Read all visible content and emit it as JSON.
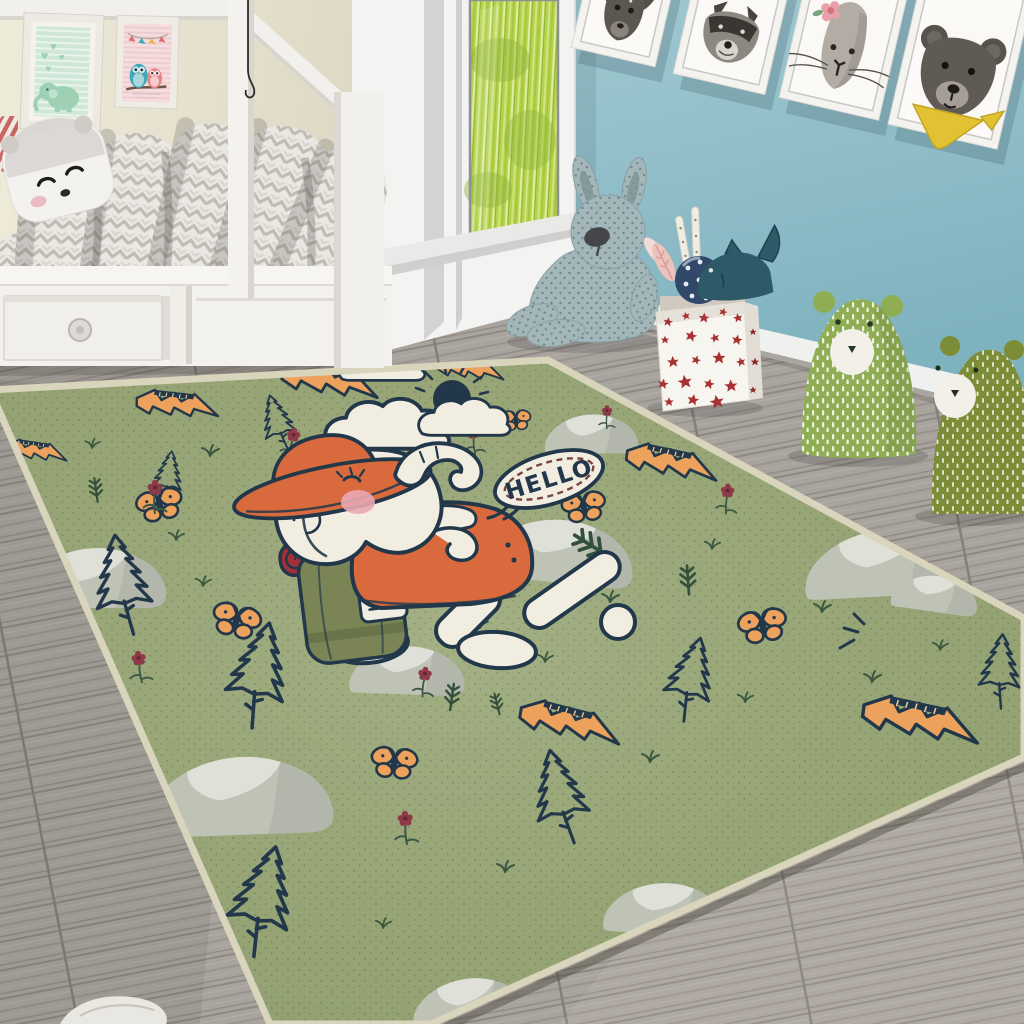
{
  "scene": {
    "description": "Children's bedroom photo: white kids bed with chevron duvet and panda pillow, glass door with grass view, blue wall with four framed animal portraits, plush toys, and a large sage-green adventure rug with a hiking elephant cartoon"
  },
  "colors": {
    "wall_blue": "#7fb2bf",
    "wall_blue_light": "#9fc8d0",
    "wall_cream": "#e9e5d3",
    "floor_gray": "#a8a39d",
    "rug_green": "#9aa878",
    "rug_binding": "#d9d4bc",
    "outline_navy": "#22384a",
    "accent_orange": "#eca25c",
    "hat_orange": "#d96a3e",
    "bedroll_red": "#a2303a",
    "backpack_olive": "#7a8455",
    "elephant_white": "#f1ede1",
    "cheek_pink": "#e9a8b2",
    "rock_gray": "#bfc3b6",
    "rock_light": "#dfe1d8",
    "grass_green": "#b6d24c",
    "bear_green": "#8fae53",
    "bear_olive": "#7d8c36",
    "plush_blue": "#a3b7ba",
    "star_red": "#a83232",
    "flower_maroon": "#8e3948",
    "bandana_yellow": "#e2c232",
    "frame_white": "#f4f3f0",
    "tick_maroon": "#7c4640"
  },
  "rug": {
    "speech_text": "HELLO",
    "motifs": [
      {
        "t": "rock",
        "x": 95,
        "y": 575,
        "s": 1.0,
        "r": 0
      },
      {
        "t": "rock",
        "x": 240,
        "y": 792,
        "s": 1.3,
        "r": -2
      },
      {
        "t": "rock",
        "x": 560,
        "y": 548,
        "s": 1.05,
        "r": 6
      },
      {
        "t": "rock",
        "x": 592,
        "y": 432,
        "s": 0.65,
        "r": 0
      },
      {
        "t": "rock",
        "x": 884,
        "y": 560,
        "s": 1.1,
        "r": -3
      },
      {
        "t": "rock",
        "x": 936,
        "y": 592,
        "s": 0.6,
        "r": 8
      },
      {
        "t": "rock",
        "x": 666,
        "y": 906,
        "s": 0.85,
        "r": 3
      },
      {
        "t": "rock",
        "x": 470,
        "y": 1000,
        "s": 0.8,
        "r": -4
      },
      {
        "t": "rock",
        "x": 408,
        "y": 668,
        "s": 0.8,
        "r": 2
      },
      {
        "t": "tree",
        "x": 278,
        "y": 424,
        "s": 0.55,
        "r": -16
      },
      {
        "t": "tree",
        "x": 168,
        "y": 478,
        "s": 0.5,
        "r": 8
      },
      {
        "t": "tree",
        "x": 122,
        "y": 586,
        "s": 0.95,
        "r": -8
      },
      {
        "t": "tree",
        "x": 258,
        "y": 676,
        "s": 1.0,
        "r": 12
      },
      {
        "t": "tree",
        "x": 690,
        "y": 680,
        "s": 0.8,
        "r": 14
      },
      {
        "t": "tree",
        "x": 560,
        "y": 798,
        "s": 0.9,
        "r": -12
      },
      {
        "t": "tree",
        "x": 262,
        "y": 902,
        "s": 1.05,
        "r": 14
      },
      {
        "t": "tree",
        "x": 1000,
        "y": 672,
        "s": 0.7,
        "r": 4
      },
      {
        "t": "bolt",
        "x": 326,
        "y": 382,
        "s": 0.95,
        "r": -6
      },
      {
        "t": "bolt",
        "x": 174,
        "y": 406,
        "s": 0.8,
        "r": -10
      },
      {
        "t": "bolt",
        "x": 34,
        "y": 452,
        "s": 0.6,
        "r": -8
      },
      {
        "t": "bolt",
        "x": 468,
        "y": 370,
        "s": 0.65,
        "r": -8
      },
      {
        "t": "bolt",
        "x": 668,
        "y": 464,
        "s": 0.9,
        "r": -4
      },
      {
        "t": "bolt",
        "x": 566,
        "y": 724,
        "s": 1.0,
        "r": -2
      },
      {
        "t": "bolt",
        "x": 916,
        "y": 722,
        "s": 1.15,
        "r": -4
      },
      {
        "t": "butterfly",
        "x": 160,
        "y": 506,
        "s": 1.0,
        "r": -12
      },
      {
        "t": "butterfly",
        "x": 236,
        "y": 622,
        "s": 1.05,
        "r": 14
      },
      {
        "t": "butterfly",
        "x": 516,
        "y": 421,
        "s": 0.65,
        "r": -4
      },
      {
        "t": "butterfly",
        "x": 584,
        "y": 508,
        "s": 0.95,
        "r": -8
      },
      {
        "t": "butterfly",
        "x": 763,
        "y": 627,
        "s": 1.05,
        "r": -10
      },
      {
        "t": "butterfly",
        "x": 394,
        "y": 764,
        "s": 1.0,
        "r": 6
      },
      {
        "t": "flower",
        "x": 155,
        "y": 498,
        "s": 1,
        "r": 0
      },
      {
        "t": "flower",
        "x": 292,
        "y": 444,
        "s": 0.9,
        "r": 10
      },
      {
        "t": "flower",
        "x": 474,
        "y": 441,
        "s": 0.85,
        "r": -6
      },
      {
        "t": "flower",
        "x": 727,
        "y": 500,
        "s": 0.9,
        "r": 4
      },
      {
        "t": "flower",
        "x": 140,
        "y": 668,
        "s": 0.95,
        "r": -8
      },
      {
        "t": "flower",
        "x": 424,
        "y": 683,
        "s": 0.9,
        "r": 6
      },
      {
        "t": "flower",
        "x": 406,
        "y": 829,
        "s": 1,
        "r": -4
      },
      {
        "t": "flower",
        "x": 607,
        "y": 418,
        "s": 0.7,
        "r": 0
      },
      {
        "t": "sprig",
        "x": 96,
        "y": 490,
        "s": 1,
        "r": -8
      },
      {
        "t": "sprig",
        "x": 302,
        "y": 452,
        "s": 0.9,
        "r": 6
      },
      {
        "t": "sprig",
        "x": 592,
        "y": 546,
        "s": 1.7,
        "r": -58
      },
      {
        "t": "sprig",
        "x": 452,
        "y": 697,
        "s": 1.1,
        "r": 8
      },
      {
        "t": "sprig",
        "x": 497,
        "y": 704,
        "s": 0.9,
        "r": -14
      },
      {
        "t": "sprig",
        "x": 688,
        "y": 580,
        "s": 1.2,
        "r": -4
      },
      {
        "t": "grass",
        "x": 210,
        "y": 456,
        "s": 1,
        "r": 0
      },
      {
        "t": "grass",
        "x": 388,
        "y": 478,
        "s": 1,
        "r": 0
      },
      {
        "t": "grass",
        "x": 300,
        "y": 522,
        "s": 0.9,
        "r": 0
      },
      {
        "t": "grass",
        "x": 448,
        "y": 554,
        "s": 1,
        "r": 0
      },
      {
        "t": "grass",
        "x": 203,
        "y": 586,
        "s": 0.9,
        "r": 0
      },
      {
        "t": "grass",
        "x": 332,
        "y": 612,
        "s": 1,
        "r": 0
      },
      {
        "t": "grass",
        "x": 480,
        "y": 628,
        "s": 0.9,
        "r": 0
      },
      {
        "t": "grass",
        "x": 610,
        "y": 602,
        "s": 1,
        "r": 0
      },
      {
        "t": "grass",
        "x": 712,
        "y": 549,
        "s": 0.9,
        "r": 0
      },
      {
        "t": "grass",
        "x": 822,
        "y": 612,
        "s": 1,
        "r": 0
      },
      {
        "t": "grass",
        "x": 545,
        "y": 662,
        "s": 0.9,
        "r": 0
      },
      {
        "t": "grass",
        "x": 650,
        "y": 762,
        "s": 1,
        "r": 0
      },
      {
        "t": "grass",
        "x": 745,
        "y": 702,
        "s": 0.9,
        "r": 0
      },
      {
        "t": "grass",
        "x": 872,
        "y": 682,
        "s": 1,
        "r": 0
      },
      {
        "t": "grass",
        "x": 505,
        "y": 872,
        "s": 1,
        "r": 0
      },
      {
        "t": "grass",
        "x": 383,
        "y": 928,
        "s": 0.9,
        "r": 0
      },
      {
        "t": "grass",
        "x": 92,
        "y": 448,
        "s": 0.85,
        "r": 0
      },
      {
        "t": "grass",
        "x": 176,
        "y": 540,
        "s": 0.9,
        "r": 0
      },
      {
        "t": "grass",
        "x": 940,
        "y": 650,
        "s": 0.9,
        "r": 0
      },
      {
        "t": "sparkle",
        "x": 866,
        "y": 628,
        "s": 1,
        "r": 0
      }
    ]
  },
  "objects": {
    "bed": "white kids bed with chevron duvet and panda pillow",
    "wall_prints_left": [
      "mint elephant print",
      "pink owls print"
    ],
    "wall_prints_right": [
      "fawn portrait",
      "raccoon portrait",
      "hare portrait with pink flower",
      "bear portrait with yellow bandana"
    ],
    "toys": [
      "blue bunny plush",
      "star storage box with shark and polka-dot ball",
      "light green bear stool",
      "olive bear stool"
    ],
    "window": "glass door with grass view"
  }
}
